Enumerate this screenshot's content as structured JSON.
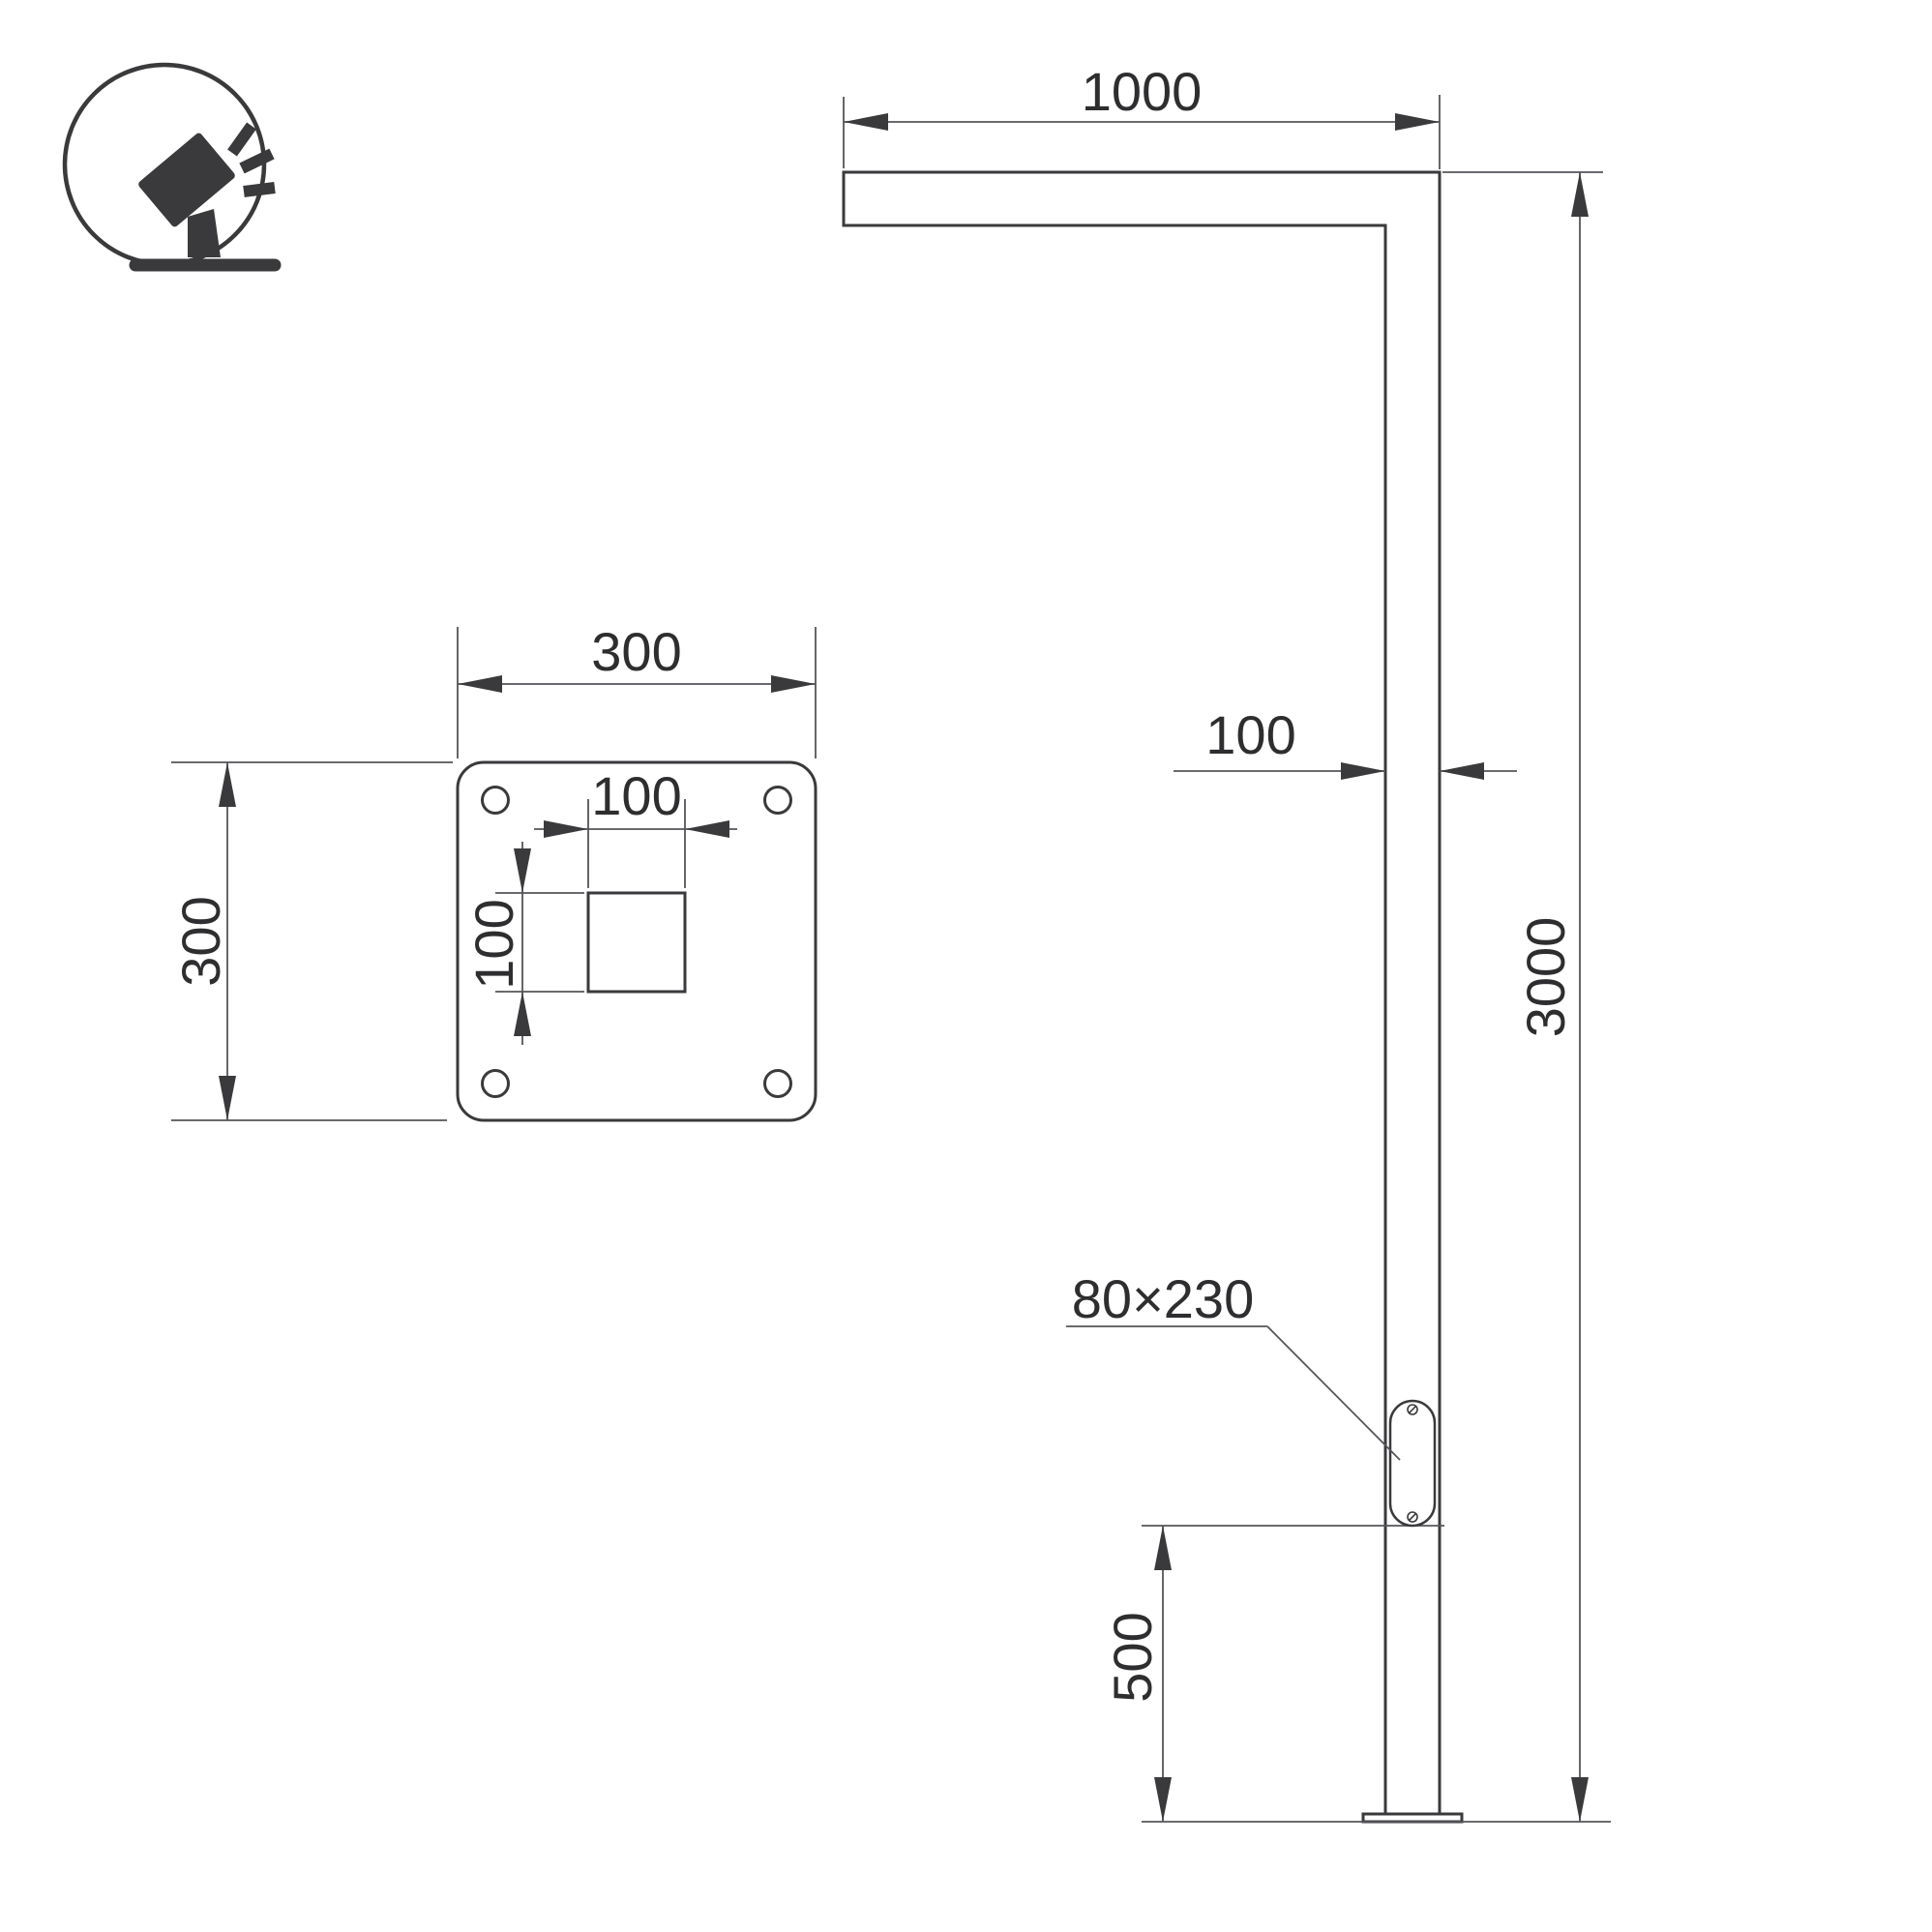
{
  "colors": {
    "line": "#3a3a3c",
    "thin": "#55555a",
    "text": "#2e2e30",
    "bg": "#ffffff"
  },
  "icon": {
    "name": "tilted-floodlight-on-ground-stand-icon",
    "shape": "circle-badge"
  },
  "plate_view": {
    "width": "300",
    "height": "300",
    "hole_width": "100",
    "hole_height": "100"
  },
  "elevation_view": {
    "arm_length": "1000",
    "pole_width": "100",
    "pole_height": "3000",
    "service_door_size": "80×230",
    "door_bottom_offset": "500"
  }
}
